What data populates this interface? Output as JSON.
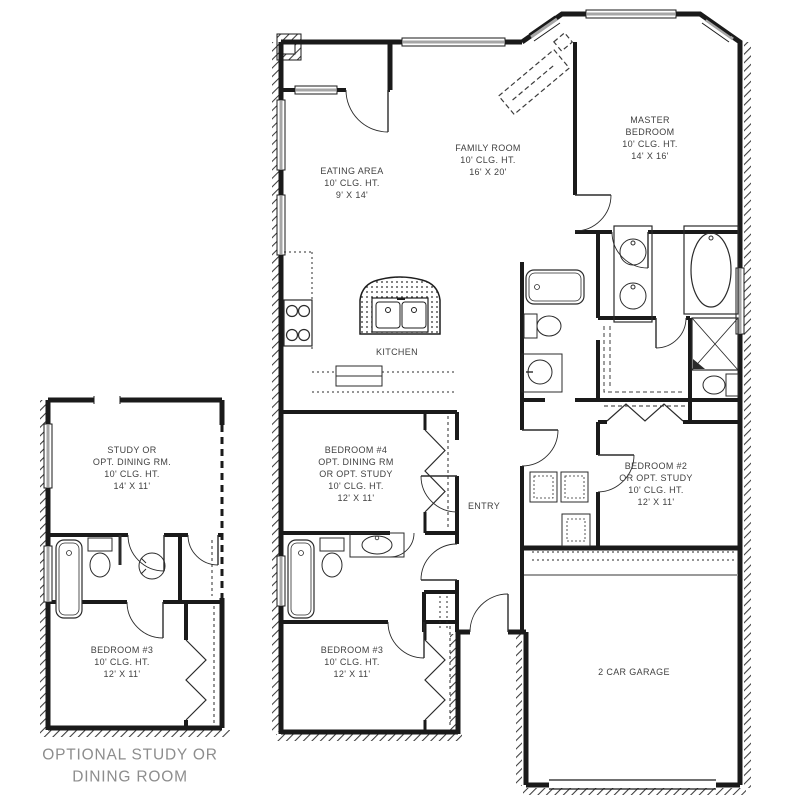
{
  "colors": {
    "wall": "#1a1a1a",
    "window": "#a6a6a6",
    "label": "#414141",
    "caption": "#8d8d8d",
    "background": "#ffffff"
  },
  "rooms": {
    "eating_area": {
      "label": "EATING AREA\n10' CLG. HT.\n9' X 14'"
    },
    "family_room": {
      "label": "FAMILY ROOM\n10' CLG. HT.\n16' X 20'"
    },
    "master_bedroom": {
      "label": "MASTER\nBEDROOM\n10' CLG. HT.\n14' X 16'"
    },
    "kitchen": {
      "label": "KITCHEN"
    },
    "bedroom_4": {
      "label": "BEDROOM #4\nOPT. DINING RM\nOR OPT. STUDY\n10' CLG. HT.\n12' X 11'"
    },
    "entry": {
      "label": "ENTRY"
    },
    "bedroom_2": {
      "label": "BEDROOM #2\nOR OPT. STUDY\n10' CLG. HT.\n12' X 11'"
    },
    "bedroom_3_main": {
      "label": "BEDROOM #3\n10' CLG. HT.\n12' X 11'"
    },
    "garage": {
      "label": "2 CAR GARAGE"
    },
    "optional_study": {
      "label": "STUDY OR\nOPT. DINING RM.\n10' CLG. HT.\n14' X 11'"
    },
    "bedroom_3_opt": {
      "label": "BEDROOM #3\n10' CLG. HT.\n12' X 11'"
    }
  },
  "caption": "OPTIONAL STUDY OR\nDINING ROOM"
}
